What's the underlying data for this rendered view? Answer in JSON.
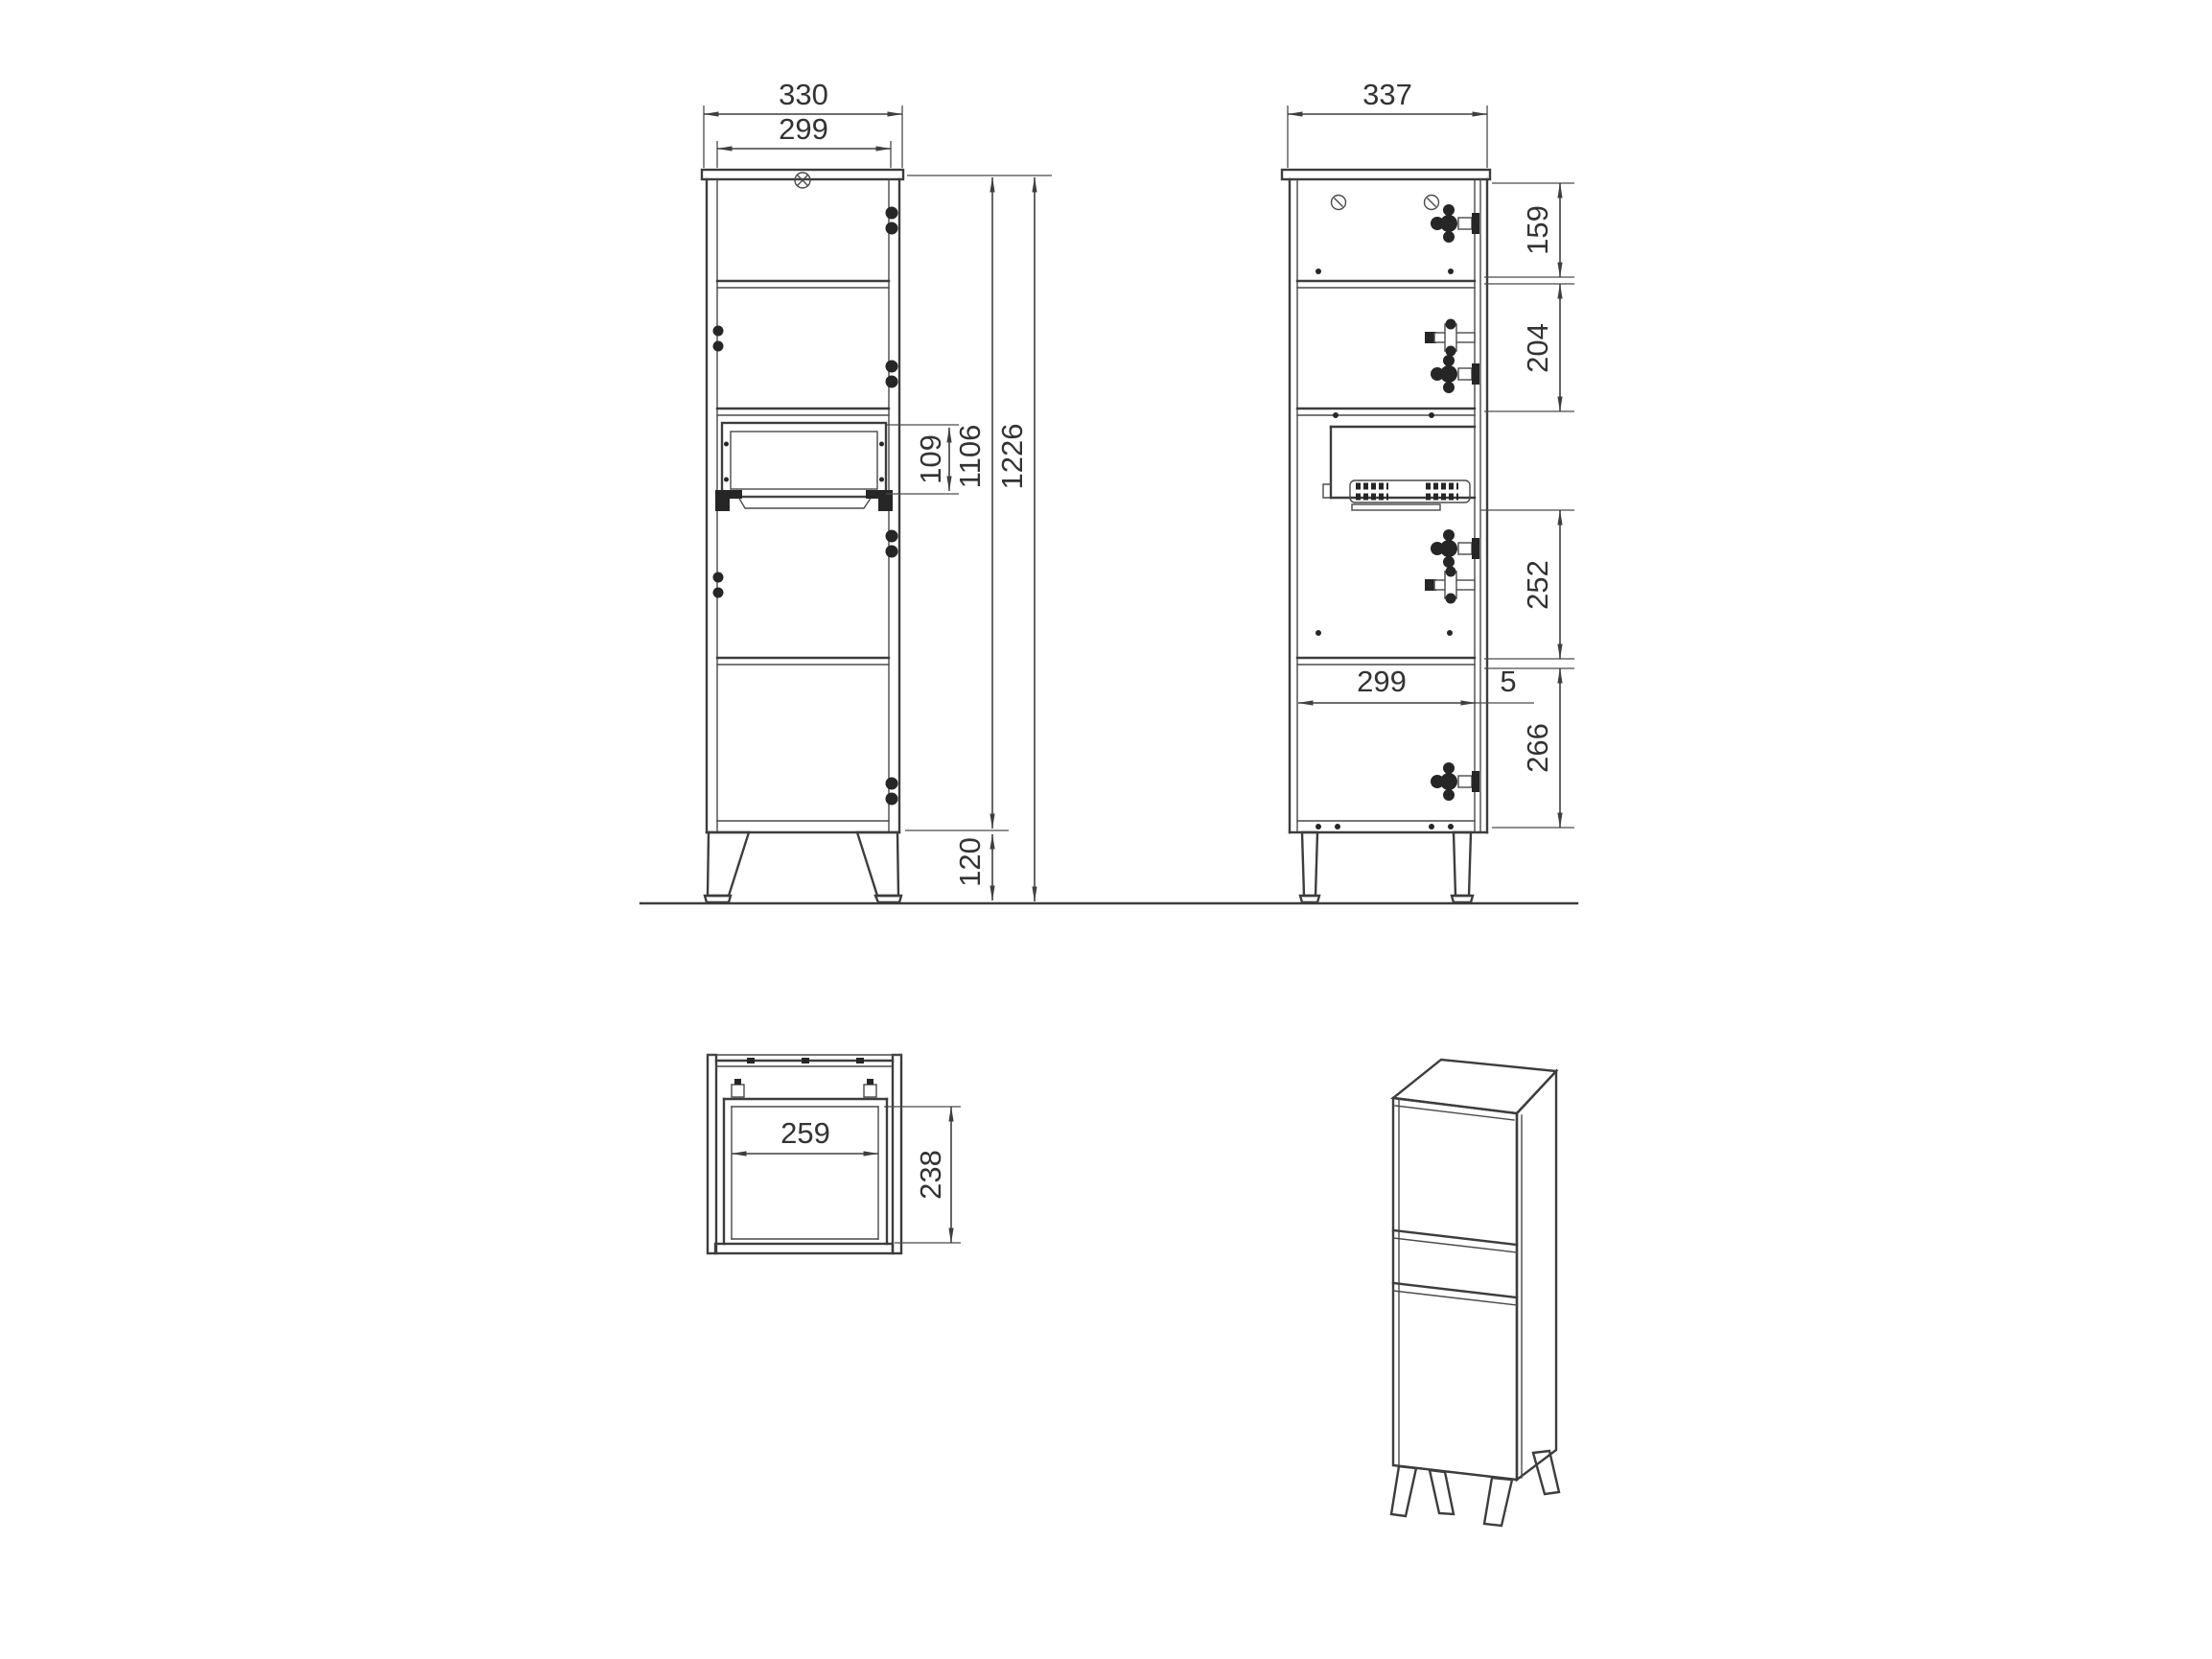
{
  "document": {
    "type": "furniture technical drawing",
    "background": "#ffffff",
    "line_color": "#3d3d3d",
    "text_color": "#333333"
  },
  "dims": {
    "front": {
      "outer_width": "330",
      "inner_width": "299",
      "niche_height": "109",
      "carcass_height": "1106",
      "total_height": "1226",
      "leg_height": "120"
    },
    "side": {
      "depth": "337",
      "section_1": "159",
      "section_2": "204",
      "section_3": "252",
      "section_4": "266",
      "interior_depth": "299",
      "door_gap": "5"
    },
    "top": {
      "opening_width": "259",
      "opening_depth": "238"
    }
  }
}
